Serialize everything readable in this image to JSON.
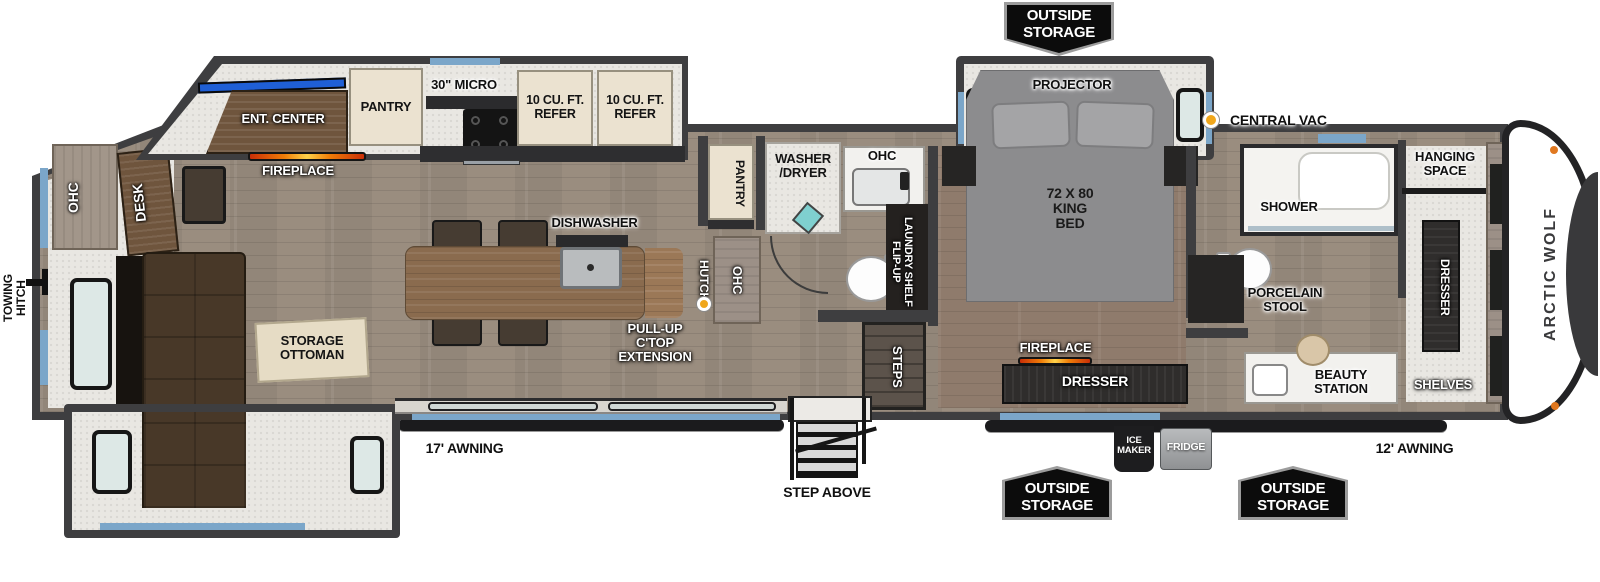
{
  "brand": {
    "name": "ARCTIC WOLF"
  },
  "legend": {
    "central_vac": "CENTRAL VAC"
  },
  "colors": {
    "wall": "#3e3e40",
    "floor_main": "#9a8d7f",
    "floor_bedroom": "#8f7b6c",
    "slide_floor": "#e9e7e2",
    "window_accent_blue": "#7ba6c9",
    "banner_bg": "#0c0c0c",
    "banner_border": "#9c9c9c",
    "central_vac_yellow": "#f0a71c",
    "fireplace_flame_orange": "#f07d08",
    "tv_blue": "#1f5fd6",
    "sofa_brown": "#483828",
    "island_wood": "#8a6b4e"
  },
  "exterior": {
    "towing_hitch": "TOWING\nHITCH",
    "awning_rear": "17' AWNING",
    "awning_front": "12' AWNING",
    "step_above": "STEP ABOVE",
    "outside_storage": "OUTSIDE\nSTORAGE",
    "ice_maker": "ICE\nMAKER",
    "fridge": "FRIDGE"
  },
  "living_area": {
    "ohc_rear": "OHC",
    "desk": "DESK",
    "ent_center": "ENT. CENTER",
    "fireplace": "FIREPLACE",
    "pantry": "PANTRY",
    "micro": "30\" MICRO",
    "refer_1": "10 CU. FT.\nREFER",
    "refer_2": "10 CU. FT.\nREFER",
    "dishwasher": "DISHWASHER",
    "storage_ottoman": "STORAGE\nOTTOMAN",
    "sectional_sofa": "SECTIONAL SOFA",
    "pull_up_ctop": "PULL-UP\nC'TOP\nEXTENSION",
    "hutch": "HUTCH",
    "ohc_hutch": "OHC"
  },
  "mid_bath": {
    "pantry": "PANTRY",
    "washer_dryer": "WASHER\n/DRYER",
    "ohc": "OHC",
    "flip_up_laundry_shelf": "FLIP-UP\nLAUNDRY SHELF",
    "steps": "STEPS"
  },
  "bedroom": {
    "projector": "PROJECTOR",
    "king_bed": "72 X 80\nKING\nBED",
    "fireplace": "FIREPLACE",
    "dresser": "DRESSER"
  },
  "front_bath": {
    "shower": "SHOWER",
    "porcelain_stool": "PORCELAIN\nSTOOL",
    "beauty_station": "BEAUTY\nSTATION"
  },
  "front_closet": {
    "hanging_space": "HANGING\nSPACE",
    "dresser": "DRESSER",
    "ohc": "OHC",
    "shelves": "SHELVES"
  }
}
